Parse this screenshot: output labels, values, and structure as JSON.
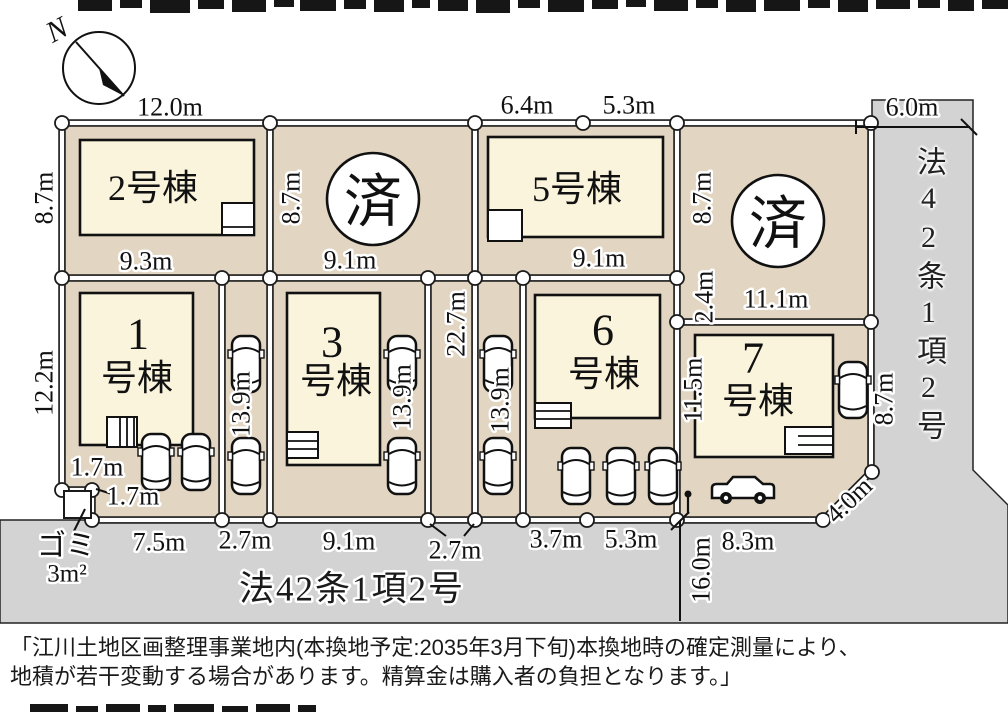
{
  "colors": {
    "lot_fill": "#e2d6c3",
    "building_fill": "#fbf4dd",
    "road_fill": "#d3d3d3",
    "line_black": "#1a1a1a",
    "boundary_white": "#ffffff"
  },
  "plan": {
    "compass_north": "N",
    "sold_mark": "済",
    "lots": {
      "lot1_line1": "1",
      "lot1_line2": "号棟",
      "lot2": "2号棟",
      "lot3_line1": "3",
      "lot3_line2": "号棟",
      "lot5": "5号棟",
      "lot6_line1": "6",
      "lot6_line2": "号棟",
      "lot7_line1": "7",
      "lot7_line2": "号棟"
    },
    "dims": {
      "top_lot2": "12.0m",
      "top_lot5_left": "6.4m",
      "top_lot5_right": "5.3m",
      "right_road_width": "6.0m",
      "lot2_left": "8.7m",
      "lot2_bottom": "9.3m",
      "lot4_left": "8.7m",
      "lot4_bottom": "9.1m",
      "lot8_left_upper": "8.7m",
      "lot8_left_lower": "2.4m",
      "lot8_bottom": "11.1m",
      "lot6_top": "9.1m",
      "lot1_left": "12.2m",
      "block_depth": "22.7m",
      "strip_left": "13.9m",
      "strip_mid": "13.9m",
      "strip_right": "13.9m",
      "lot7_left": "11.5m",
      "lot7_right": "8.7m",
      "waste_width": "1.7m",
      "waste_height": "1.7m",
      "frontage_lot1": "7.5m",
      "frontage_strip1": "2.7m",
      "frontage_lot3": "9.1m",
      "frontage_corridor": "2.7m",
      "frontage_lot6_left": "3.7m",
      "frontage_lot6_right": "5.3m",
      "frontage_lot7": "8.3m",
      "corner_chamfer": "4.0m",
      "road_length": "16.0m"
    },
    "waste_station": {
      "label": "ゴミ",
      "area": "3m²"
    },
    "roads": {
      "bottom": "法42条1項2号",
      "right": "法42条1項2号"
    }
  },
  "note": {
    "line1": "「江川土地区画整理事業地内(本換地予定:2035年3月下旬)本換地時の確定測量により、",
    "line2": "地積が若干変動する場合があります。精算金は購入者の負担となります。」"
  }
}
